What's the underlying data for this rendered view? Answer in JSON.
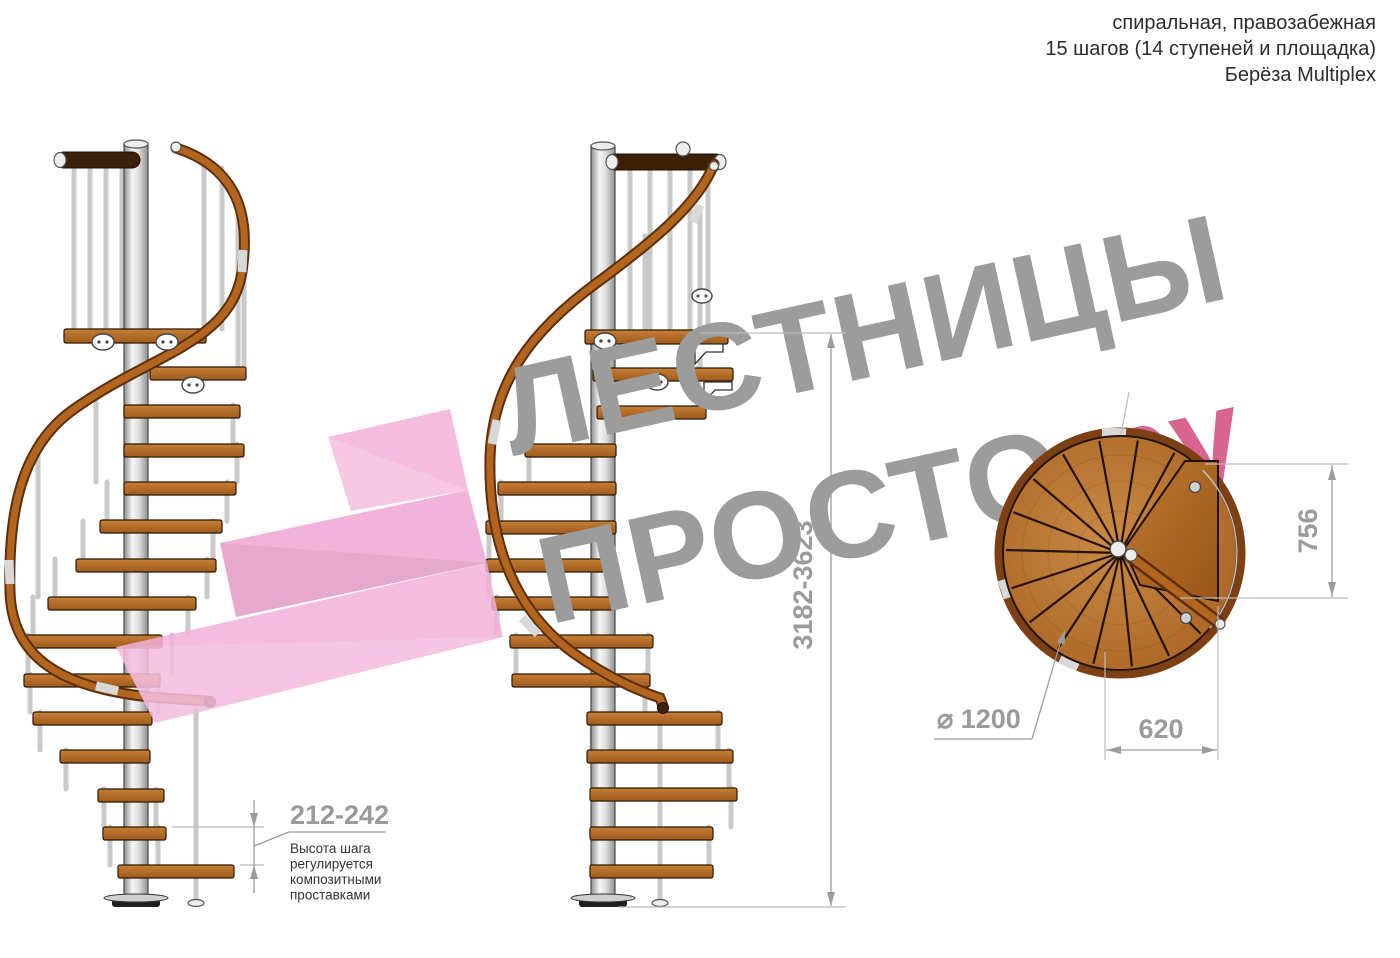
{
  "header": {
    "line1": "спиральная, правозабежная",
    "line2": "15 шагов (14 ступеней и площадка)",
    "line3": "Берёза Multiplex"
  },
  "watermark": {
    "word1": "ЛЕСТНИЦЫ",
    "word2": "ПРОСТО",
    "word2_suffix": ".ру"
  },
  "dimensions": {
    "total_height": "3182-3623",
    "plan_depth": "756",
    "plan_width": "620",
    "diameter": "⌀ 1200",
    "step_height": "212-242",
    "step_note": [
      "Высота шага",
      "регулируется",
      "композитными",
      "проставками"
    ]
  },
  "colors": {
    "watermark_gray": "#9b9b9b",
    "brand_pink": "#d35080",
    "logo_pink": "#f2b0d8",
    "wood": "#b06a28",
    "wood_dark": "#7a4314",
    "steel": "#e6e6e6",
    "dim_gray": "#9b9b9b",
    "text_dark": "#333333"
  }
}
